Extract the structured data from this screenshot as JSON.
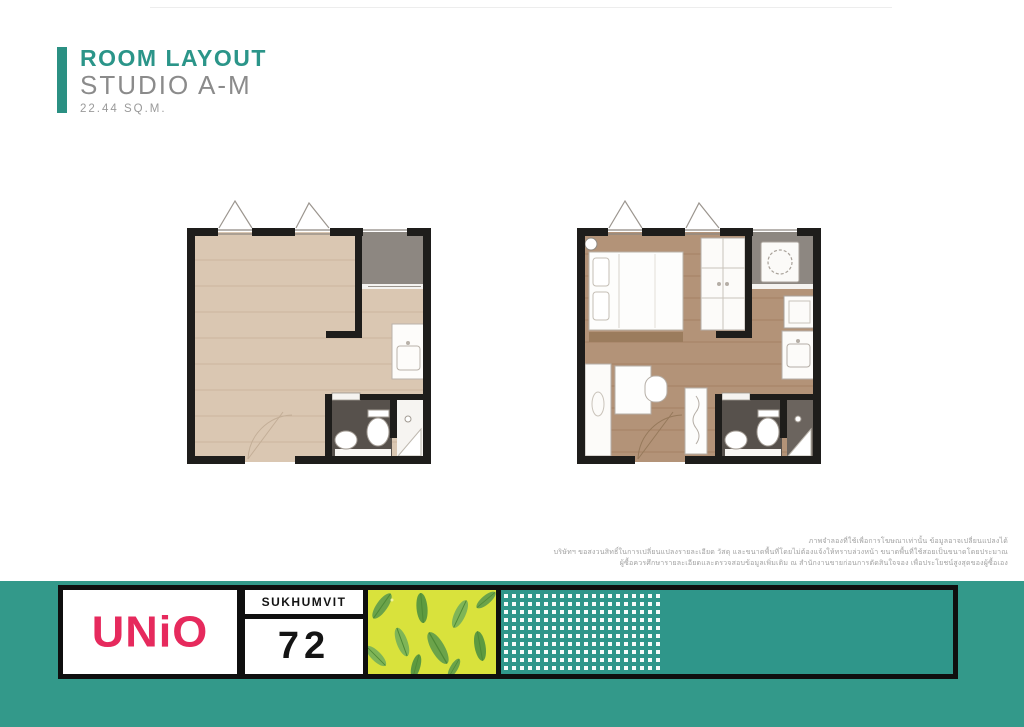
{
  "header": {
    "title": "ROOM LAYOUT",
    "subtitle": "STUDIO A-M",
    "area": "22.44 SQ.M."
  },
  "disclaimer": {
    "lines": [
      "ภาพจำลองที่ใช้เพื่อการโฆษณาเท่านั้น ข้อมูลอาจเปลี่ยนแปลงได้",
      "บริษัทฯ ขอสงวนสิทธิ์ในการเปลี่ยนแปลงรายละเอียด วัสดุ และขนาดพื้นที่โดยไม่ต้องแจ้งให้ทราบล่วงหน้า ขนาดพื้นที่ใช้สอยเป็นขนาดโดยประมาณ",
      "ผู้ซื้อควรศึกษารายละเอียดและตรวจสอบข้อมูลเพิ่มเติม ณ สำนักงานขายก่อนการตัดสินใจจอง เพื่อประโยชน์สูงสุดของผู้ซื้อเอง"
    ]
  },
  "footer": {
    "brand": "UNiO",
    "street": "SUKHUMVIT",
    "street_number": "72"
  },
  "colors": {
    "accent_teal": "#2b9083",
    "footer_teal": "#33998a",
    "brand_pink": "#e62a5d",
    "leaf_background": "#d9e23c",
    "leaf_green": "#6ba34a",
    "wall_black": "#1e1d1b",
    "floor_light": "#dac7b2",
    "floor_dark": "#b39378",
    "balcony_gray": "#8d8781",
    "bathroom_gray": "#57514c"
  }
}
